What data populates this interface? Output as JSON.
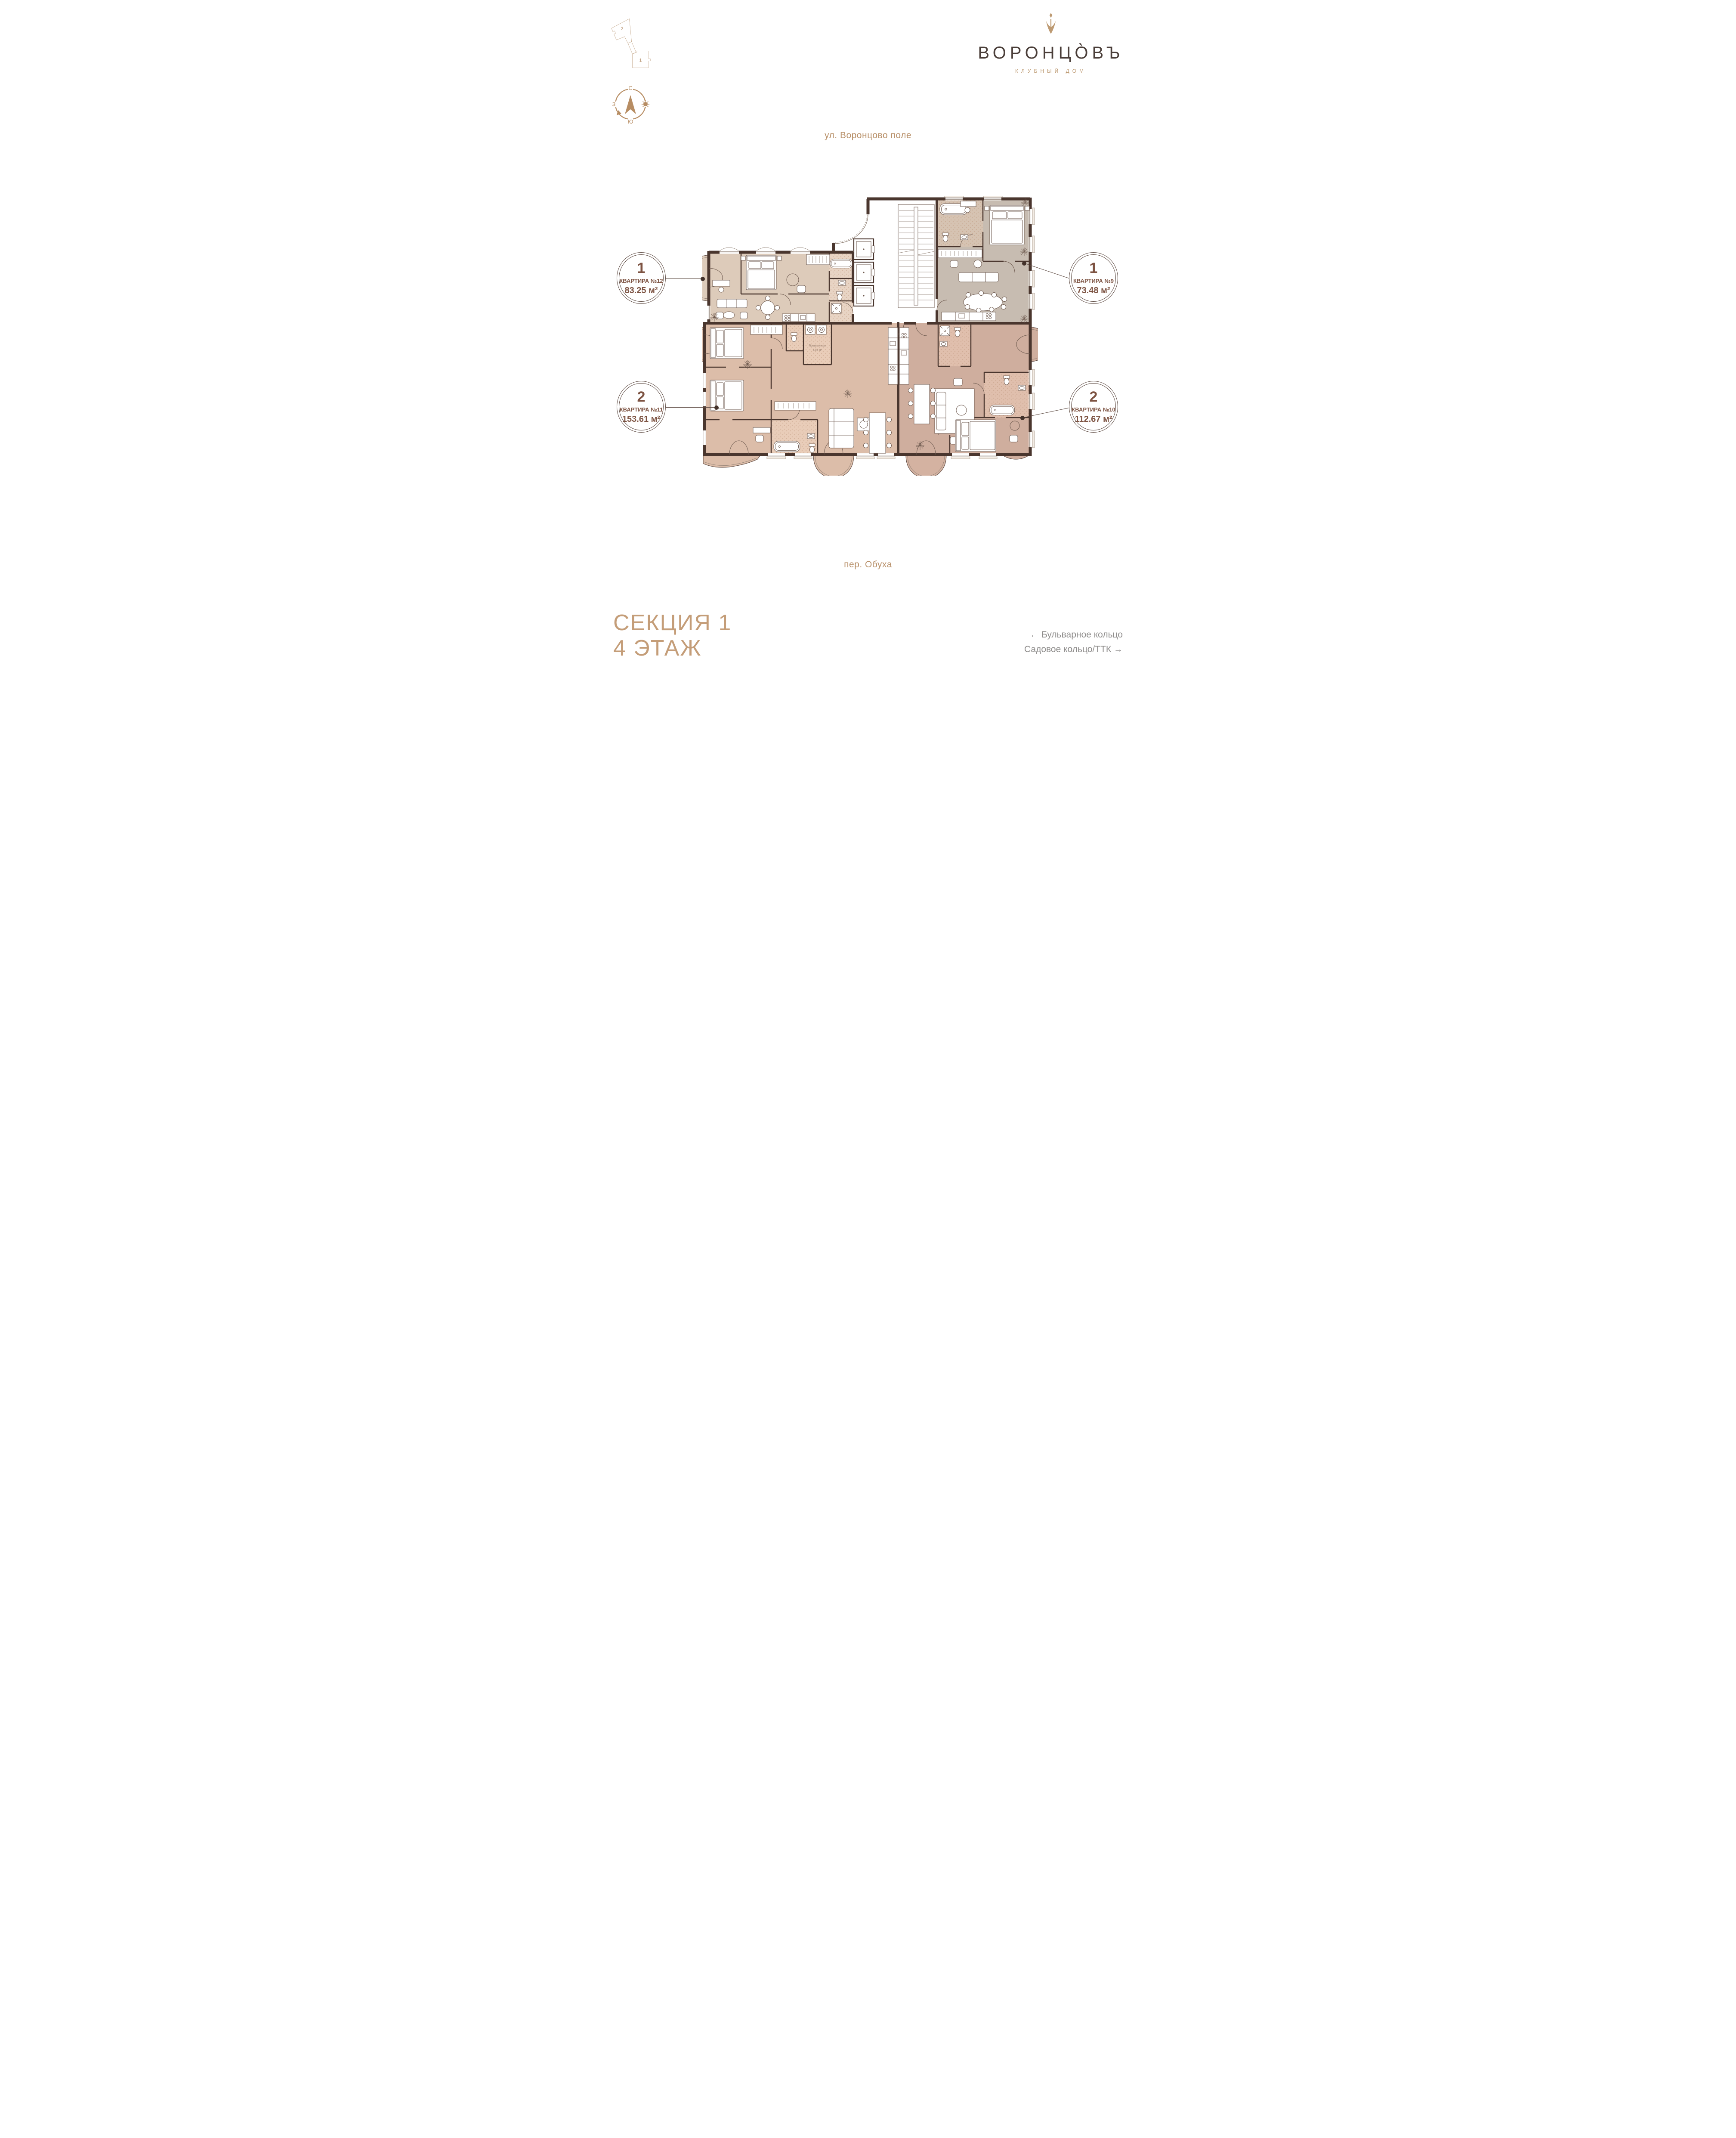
{
  "colors": {
    "accent_tan": "#b78d63",
    "accent_gold": "#bd9a72",
    "text_brown": "#7d5342",
    "wall": "#4a362e",
    "nav_gray": "#8e8c8b",
    "apt12_fill": "#ddcbba",
    "apt9_fill": "#c7bcb1",
    "apt11_fill": "#dcbda9",
    "apt10_fill": "#cfae9e"
  },
  "logo": {
    "title": "ВОРОНЦО̀ВЪ",
    "subtitle": "КЛУБНЫЙ ДОМ"
  },
  "minimap": {
    "section_2_label": "2",
    "section_1_label": "1"
  },
  "compass": {
    "north": "С",
    "west": "З",
    "south": "Ю"
  },
  "streets": {
    "top": "ул. Воронцово поле",
    "bottom": "пер. Обуха"
  },
  "plan": {
    "laundry_label": "Постирочная",
    "laundry_area": "6.08 м²"
  },
  "callouts": [
    {
      "rooms": "1",
      "name": "КВАРТИРА №12",
      "area": "83.25 м²"
    },
    {
      "rooms": "1",
      "name": "КВАРТИРА №9",
      "area": "73.48 м²"
    },
    {
      "rooms": "2",
      "name": "КВАРТИРА №11",
      "area": "153.61 м²"
    },
    {
      "rooms": "2",
      "name": "КВАРТИРА №10",
      "area": "112.67 м²"
    }
  ],
  "footer": {
    "section": "СЕКЦИЯ 1",
    "floor": "4 ЭТАЖ",
    "nav_line1": "← Бульварное кольцо",
    "nav_line2": "Садовое кольцо/ТТК →"
  }
}
